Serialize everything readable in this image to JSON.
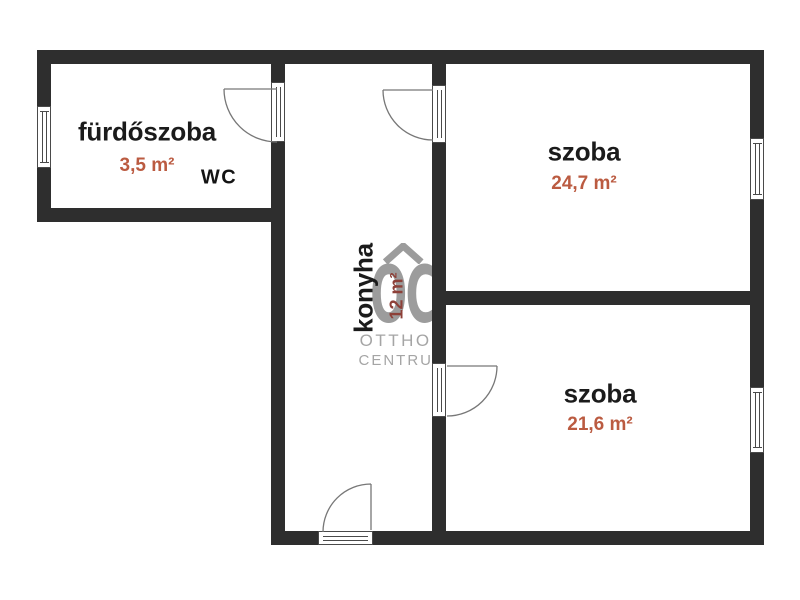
{
  "rooms": {
    "furdoszoba": {
      "name": "fürdőszoba",
      "area": "3,5 m²"
    },
    "wc": {
      "name": "WC"
    },
    "konyha": {
      "name": "konyha",
      "area": "12 m²"
    },
    "szoba_top": {
      "name": "szoba",
      "area": "24,7 m²"
    },
    "szoba_bottom": {
      "name": "szoba",
      "area": "21,6 m²"
    }
  },
  "watermark": {
    "monogram": "OC",
    "brand_line1": "OTTHON",
    "brand_line2": "CENTRUM"
  },
  "colors": {
    "wall": "#2e2e2e",
    "room_name": "#1b1b1b",
    "area_accent": "#bb5b41",
    "konyha_area_accent": "#8d4038",
    "watermark_gray": "#9c9c9c",
    "background": "#ffffff"
  },
  "icons": {
    "roof": "chevron-up-roof",
    "door": "quarter-circle-door-swing",
    "window": "triple-line-window"
  }
}
